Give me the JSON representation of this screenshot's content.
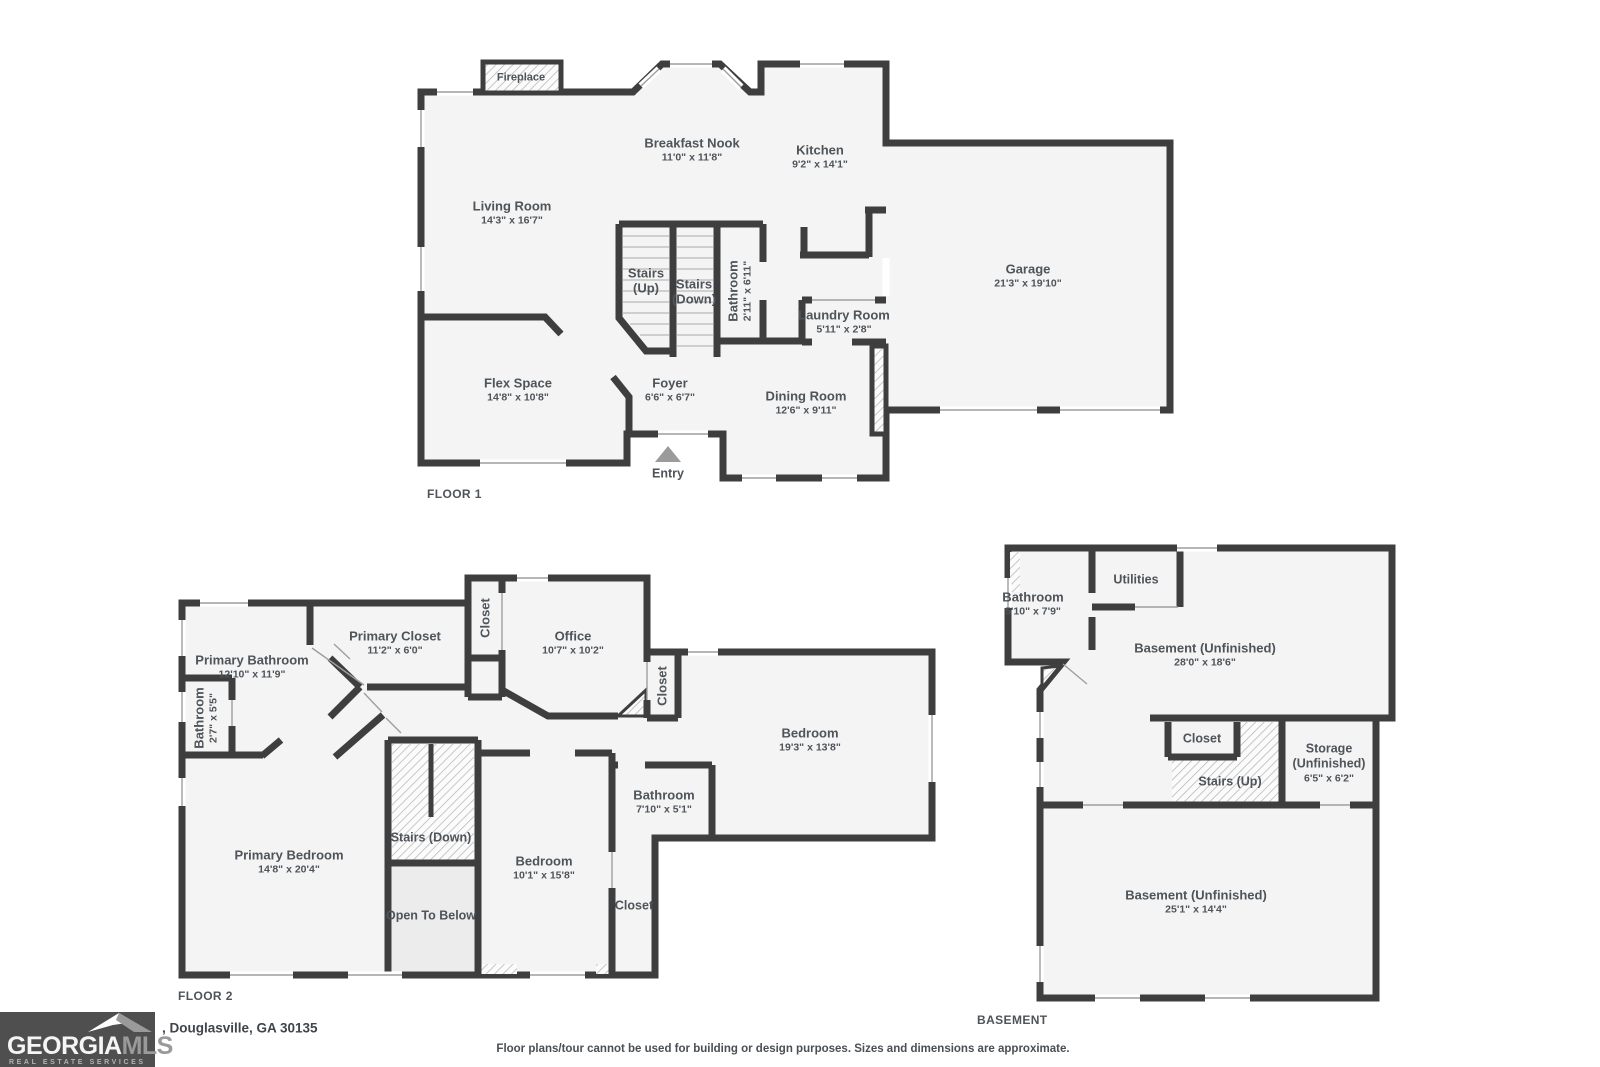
{
  "colors": {
    "wall": "#3e3e3e",
    "room_fill": "#f4f4f4",
    "open_to_below_fill": "#ececec",
    "hatch_line": "#b5b5b5",
    "label_text": "#4e545a",
    "entry_arrow": "#9b9b9b",
    "logo_bg": "#4f4f4f"
  },
  "logo": {
    "brand_primary": "GEORGIA",
    "brand_secondary": "MLS",
    "tagline": "REAL ESTATE SERVICES"
  },
  "footer": {
    "address": ", Douglasville, GA 30135",
    "disclaimer": "Floor plans/tour cannot be used for building or design purposes. Sizes and dimensions are approximate."
  },
  "floors": {
    "floor1": {
      "label": "FLOOR 1",
      "rooms": {
        "fireplace": {
          "name": "Fireplace"
        },
        "breakfast_nook": {
          "name": "Breakfast Nook",
          "dims": "11'0\" x 11'8\""
        },
        "kitchen": {
          "name": "Kitchen",
          "dims": "9'2\" x 14'1\""
        },
        "living_room": {
          "name": "Living Room",
          "dims": "14'3\" x 16'7\""
        },
        "garage": {
          "name": "Garage",
          "dims": "21'3\" x 19'10\""
        },
        "stairs_up": {
          "line1": "Stairs",
          "line2": "(Up)"
        },
        "stairs_down": {
          "line1": "Stairs",
          "line2": "(Down)"
        },
        "bathroom": {
          "name": "Bathroom",
          "dims": "2'11\" x 6'11\""
        },
        "laundry_room": {
          "name": "Laundry Room",
          "dims": "5'11\" x 2'8\""
        },
        "flex_space": {
          "name": "Flex Space",
          "dims": "14'8\" x 10'8\""
        },
        "foyer": {
          "name": "Foyer",
          "dims": "6'6\" x 6'7\""
        },
        "dining_room": {
          "name": "Dining Room",
          "dims": "12'6\" x 9'11\""
        },
        "entry": {
          "name": "Entry"
        }
      }
    },
    "floor2": {
      "label": "FLOOR 2",
      "rooms": {
        "primary_bathroom": {
          "name": "Primary Bathroom",
          "dims": "12'10\" x 11'9\""
        },
        "bathroom_small": {
          "name": "Bathroom",
          "dims": "2'7\" x 5'5\""
        },
        "primary_closet": {
          "name": "Primary Closet",
          "dims": "11'2\" x 6'0\""
        },
        "closet_left": {
          "name": "Closet"
        },
        "office": {
          "name": "Office",
          "dims": "10'7\" x 10'2\""
        },
        "closet_mid": {
          "name": "Closet"
        },
        "bedroom_large": {
          "name": "Bedroom",
          "dims": "19'3\" x 13'8\""
        },
        "bathroom_hall": {
          "name": "Bathroom",
          "dims": "7'10\" x 5'1\""
        },
        "primary_bedroom": {
          "name": "Primary Bedroom",
          "dims": "14'8\" x 20'4\""
        },
        "stairs_down": {
          "name": "Stairs (Down)"
        },
        "open_to_below": {
          "name": "Open To Below"
        },
        "bedroom_small": {
          "name": "Bedroom",
          "dims": "10'1\" x 15'8\""
        },
        "closet_bottom": {
          "name": "Closet"
        }
      }
    },
    "basement": {
      "label": "BASEMENT",
      "rooms": {
        "bathroom": {
          "name": "Bathroom",
          "dims": "5'10\" x 7'9\""
        },
        "utilities": {
          "name": "Utilities"
        },
        "basement_upper": {
          "name": "Basement (Unfinished)",
          "dims": "28'0\" x 18'6\""
        },
        "closet": {
          "name": "Closet"
        },
        "stairs_up": {
          "name": "Stairs (Up)"
        },
        "storage": {
          "line1": "Storage",
          "line2": "(Unfinished)",
          "dims": "6'5\" x 6'2\""
        },
        "basement_lower": {
          "name": "Basement (Unfinished)",
          "dims": "25'1\" x 14'4\""
        }
      }
    }
  }
}
